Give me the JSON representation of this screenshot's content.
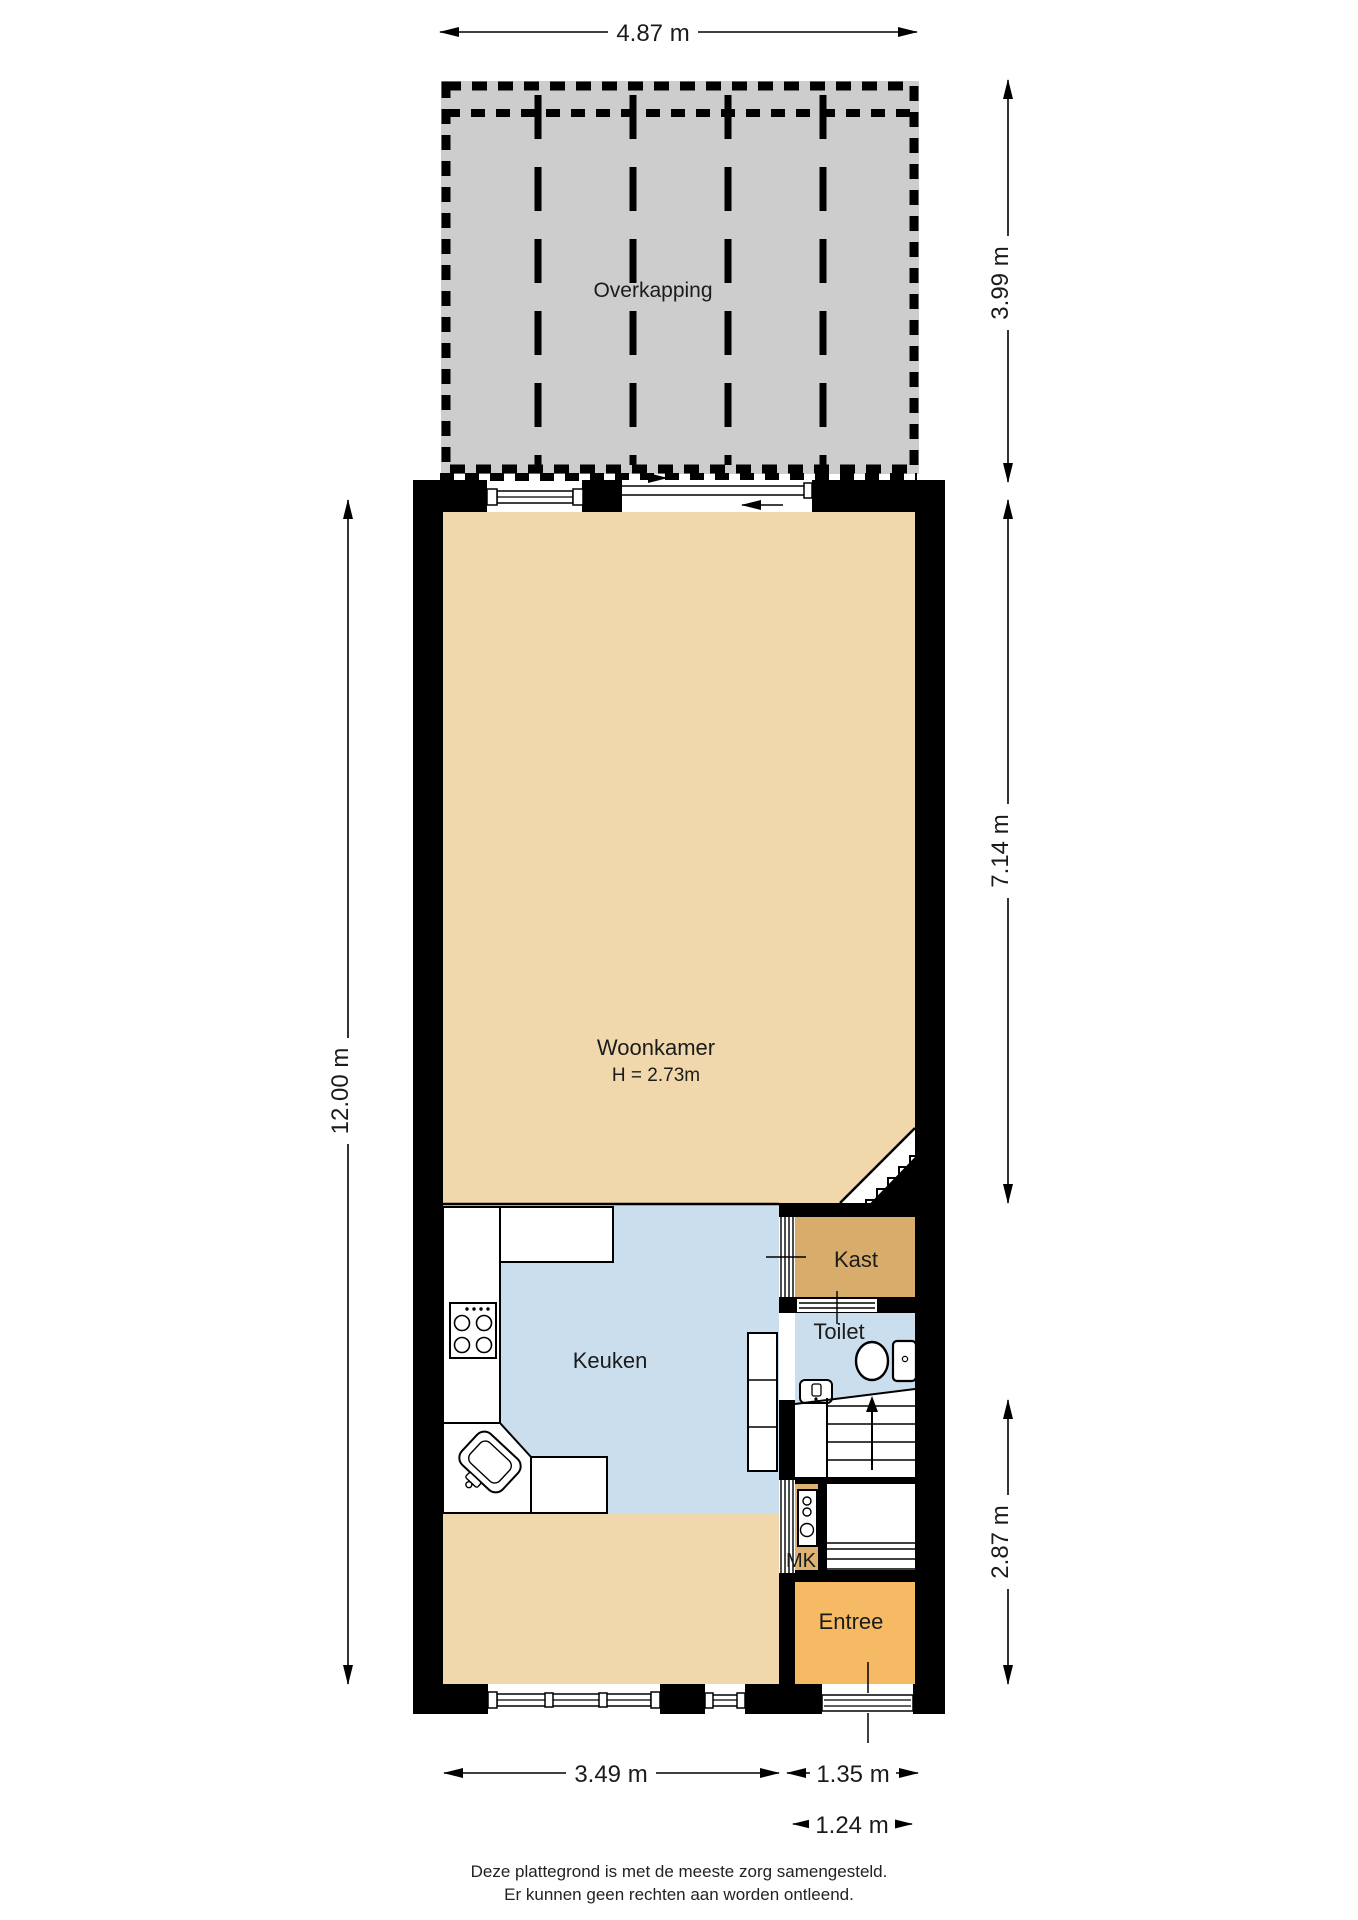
{
  "plan": {
    "title": "floor plan (ground floor)",
    "rooms": {
      "overkapping": {
        "label": "Overkapping"
      },
      "woonkamer": {
        "label": "Woonkamer",
        "height_note": "H = 2.73m"
      },
      "keuken": {
        "label": "Keuken"
      },
      "kast": {
        "label": "Kast"
      },
      "toilet": {
        "label": "Toilet"
      },
      "mk": {
        "label": "MK"
      },
      "entree": {
        "label": "Entree"
      }
    },
    "dimensions": {
      "top_width": "4.87 m",
      "overkapping_depth": "3.99 m",
      "woonkamer_depth": "7.14 m",
      "rear_depth": "2.87 m",
      "total_depth": "12.00 m",
      "bottom_left_width": "3.49 m",
      "bottom_right_width": "1.35 m",
      "front_door_width": "1.24 m"
    },
    "colors": {
      "wall": "#000000",
      "woonkamer": "#F1D8AC",
      "keuken": "#CADEEE",
      "toilet": "#CADEEE",
      "kast": "#D8AC6B",
      "mk": "#DDB273",
      "entree": "#F6BA65",
      "overkapping": "#CDCDCD"
    },
    "footer": {
      "line1": "Deze plattegrond is met de meeste zorg samengesteld.",
      "line2": "Er kunnen geen rechten aan worden ontleend."
    }
  }
}
